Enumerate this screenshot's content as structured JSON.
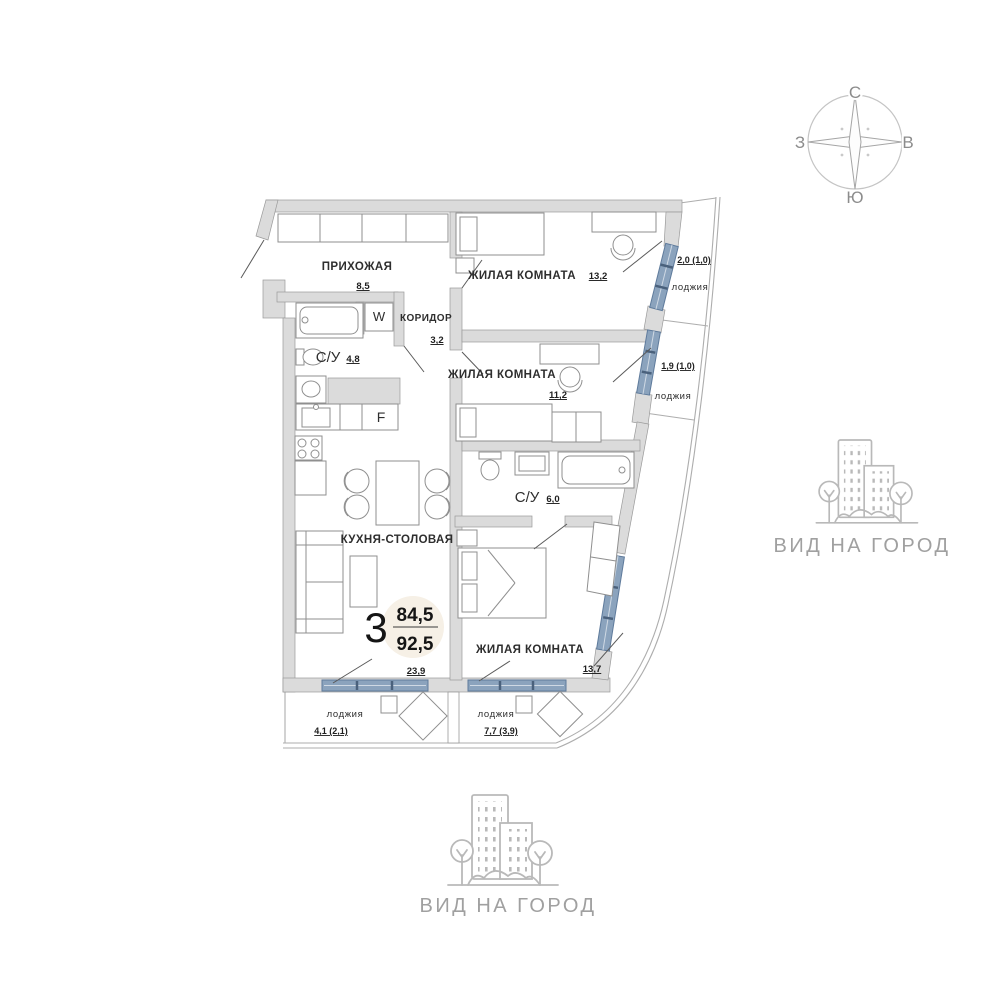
{
  "compass": {
    "north": "С",
    "south": "Ю",
    "west": "З",
    "east": "В"
  },
  "badge": {
    "rooms": "3",
    "living_area": "84,5",
    "total_area": "92,5"
  },
  "rooms": {
    "hallway": {
      "name": "ПРИХОЖАЯ",
      "area": "8,5"
    },
    "bedroom1": {
      "name": "ЖИЛАЯ КОМНАТА",
      "area": "13,2"
    },
    "corridor": {
      "name": "КОРИДОР",
      "area": "3,2"
    },
    "bathroom1": {
      "name": "С/У",
      "area": "4,8"
    },
    "bedroom2": {
      "name": "ЖИЛАЯ КОМНАТА",
      "area": "11,2"
    },
    "bathroom2": {
      "name": "С/У",
      "area": "6,0"
    },
    "kitchen": {
      "name": "КУХНЯ-СТОЛОВАЯ",
      "area": "23,9"
    },
    "bedroom3": {
      "name": "ЖИЛАЯ КОМНАТА",
      "area": "13,7"
    }
  },
  "loggias": {
    "top": {
      "name": "лоджия",
      "area": "2,0 (1,0)"
    },
    "middle": {
      "name": "лоджия",
      "area": "1,9 (1,0)"
    },
    "bottom_left": {
      "name": "лоджия",
      "area": "4,1 (2,1)"
    },
    "bottom_right": {
      "name": "лоджия",
      "area": "7,7 (3,9)"
    }
  },
  "appliances": {
    "washer": "W",
    "fridge": "F"
  },
  "views": {
    "right": "ВИД НА ГОРОД",
    "bottom": "ВИД НА ГОРОД"
  },
  "colors": {
    "glazing": "#8ba3bd",
    "walls": "#dcdcdc",
    "badge_bg": "#f6f0e6",
    "view_gray": "#b5b5b5",
    "text_dark": "#2e2e2e"
  }
}
